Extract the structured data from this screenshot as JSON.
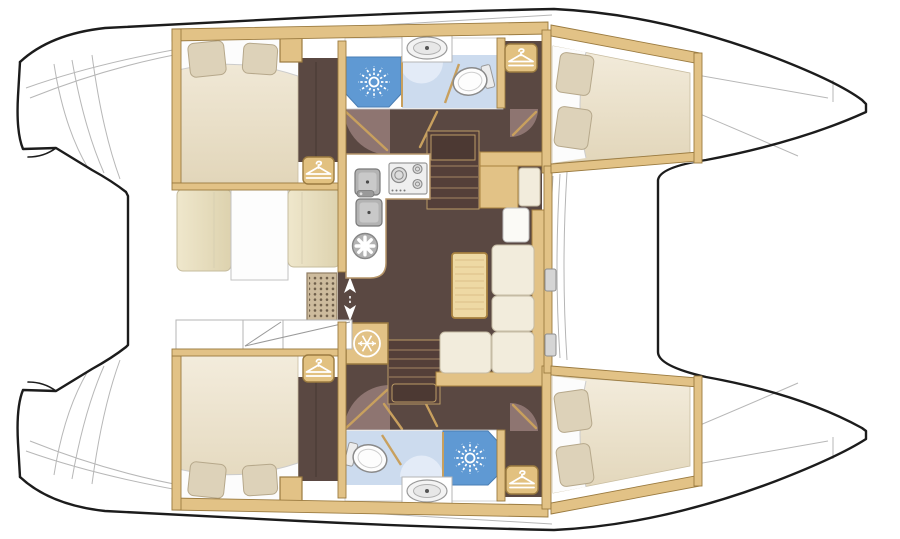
{
  "page": {
    "description": "Catamaran sailing yacht interior layout plan, top view, bows pointing right, 4 cabins, 2 bathrooms, saloon with galley",
    "background": "#ffffff"
  },
  "colors": {
    "hull_outline": "#1c1c1c",
    "deck_line": "#b7b7b7",
    "floor_wood_dark": "#5a4842",
    "stair_dark": "#543f39",
    "stair_landing": "#4c3933",
    "door_swing": "#8e7571",
    "wall_wood": "#e2c286",
    "wall_wood_border": "#9b7b40",
    "wood_trim": "#c8a05e",
    "table_wood": "#eed9a4",
    "table_stripe": "#dcc088",
    "cushion_cream": "#f2ecdc",
    "bench_beige": "#e9e0c3",
    "mattress_beige": "#ece3cd",
    "pillow_beige": "#ddd2b9",
    "shower_blue": "#5f99d3",
    "bath_floor_blue": "#ccdbee",
    "bath_arc_blue": "#e3ebf7",
    "fixture_gray": "#b3b3b3",
    "grate_bg": "#cdbb9d",
    "grate_dot": "#6f5f4b",
    "icon_white": "#ffffff"
  },
  "icons": [
    {
      "name": "shower-starburst-icon",
      "meaning": "shower head spray",
      "count": 2
    },
    {
      "name": "hanger-icon",
      "meaning": "wardrobe / hanging locker",
      "count": 4
    },
    {
      "name": "snowflake-icon",
      "meaning": "refrigerator",
      "count": 1
    },
    {
      "name": "fan-icon",
      "meaning": "round galley fixture",
      "count": 1
    },
    {
      "name": "updown-arrows-icon",
      "meaning": "sliding door to cockpit",
      "count": 1
    },
    {
      "name": "toilet-icon",
      "meaning": "marine toilet",
      "count": 2
    },
    {
      "name": "washbasin-icon",
      "meaning": "washbasin",
      "count": 2
    },
    {
      "name": "stove-icon",
      "meaning": "3-burner cooktop",
      "count": 1
    },
    {
      "name": "sink-icon",
      "meaning": "galley double sink",
      "count": 2
    }
  ],
  "rooms": {
    "aft_cabin_top": {
      "label": "aft cabin",
      "features": [
        "double berth",
        "2 pillows",
        "wardrobe",
        "dark wood floor"
      ]
    },
    "aft_cabin_bottom": {
      "label": "aft cabin",
      "features": [
        "double berth",
        "2 pillows",
        "wardrobe",
        "dark wood floor"
      ]
    },
    "forward_cabin_top": {
      "label": "forward cabin",
      "features": [
        "double berth",
        "2 pillows"
      ]
    },
    "forward_cabin_bottom": {
      "label": "forward cabin",
      "features": [
        "double berth",
        "2 pillows"
      ]
    },
    "bathroom_top": {
      "label": "bathroom",
      "features": [
        "shower",
        "washbasin",
        "toilet"
      ]
    },
    "bathroom_bottom": {
      "label": "bathroom",
      "features": [
        "shower",
        "washbasin",
        "toilet"
      ]
    },
    "galley": {
      "label": "galley",
      "features": [
        "double sink",
        "3-burner stove",
        "refrigerator"
      ]
    },
    "saloon": {
      "label": "saloon",
      "features": [
        "L-shaped sofa",
        "table",
        "nav seat",
        "2 companionway stairs"
      ]
    },
    "cockpit": {
      "label": "cockpit",
      "features": [
        "bench seats",
        "floor grating",
        "stern lockers"
      ]
    },
    "foredeck": {
      "label": "foredeck",
      "features": [
        "trampoline opening",
        "anchor lockers"
      ]
    }
  }
}
